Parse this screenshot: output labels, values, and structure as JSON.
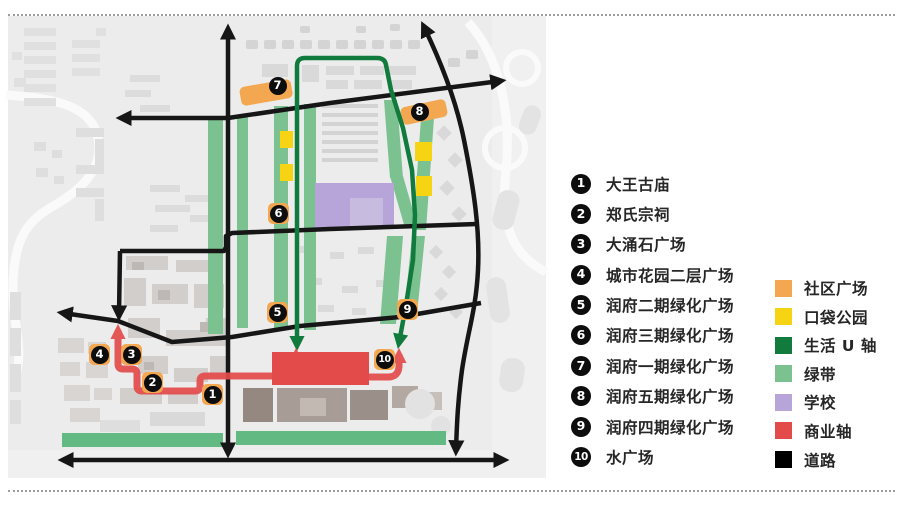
{
  "map": {
    "markers": [
      "1",
      "2",
      "3",
      "4",
      "5",
      "6",
      "7",
      "8",
      "9",
      "10"
    ]
  },
  "legend": {
    "numbered_items": [
      {
        "num": "1",
        "label": "大王古庙"
      },
      {
        "num": "2",
        "label": "郑氏宗祠"
      },
      {
        "num": "3",
        "label": "大涌石广场"
      },
      {
        "num": "4",
        "label": "城市花园二层广场"
      },
      {
        "num": "5",
        "label": "润府二期绿化广场"
      },
      {
        "num": "6",
        "label": "润府三期绿化广场"
      },
      {
        "num": "7",
        "label": "润府一期绿化广场"
      },
      {
        "num": "8",
        "label": "润府五期绿化广场"
      },
      {
        "num": "9",
        "label": "润府四期绿化广场"
      },
      {
        "num": "10",
        "label": "水广场"
      }
    ],
    "color_items": [
      {
        "label": "社区广场",
        "color": "#F2A750"
      },
      {
        "label": "口袋公园",
        "color": "#F6D414"
      },
      {
        "label": "生活 U 轴",
        "color": "#117A3D"
      },
      {
        "label": "绿带",
        "color": "#7CC291"
      },
      {
        "label": "学校",
        "color": "#B7A4D8"
      },
      {
        "label": "商业轴",
        "color": "#E34B4B"
      },
      {
        "label": "道路",
        "color": "#000000"
      }
    ]
  }
}
